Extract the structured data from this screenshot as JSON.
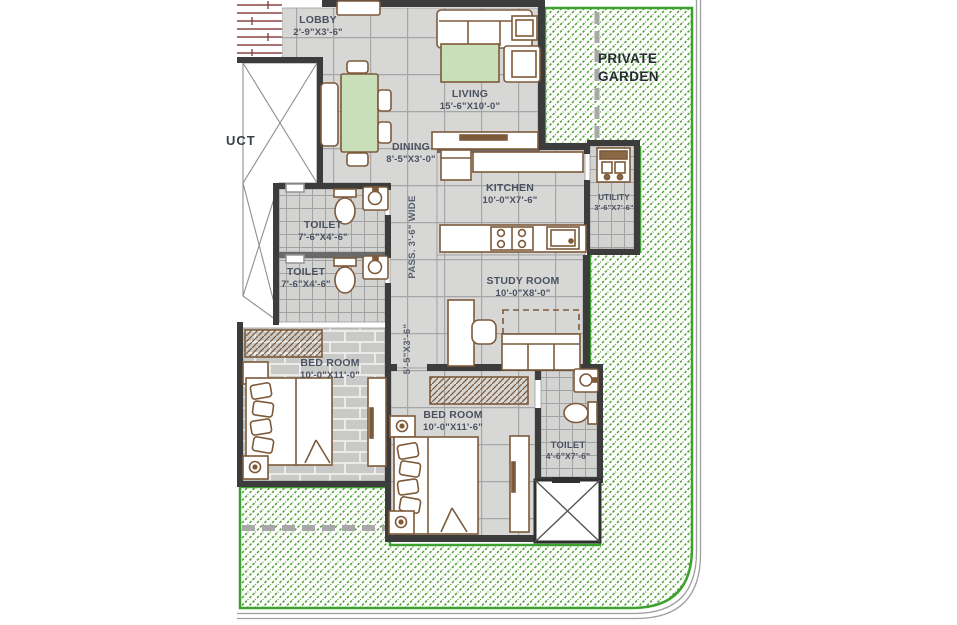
{
  "title": "Apartment floor plan with private garden",
  "garden": {
    "label": "PRIVATE GARDEN"
  },
  "annotations": {
    "duct": "UCT",
    "passage_width": "PASS. 3'-6\" WIDE",
    "passage_dim": "5'-5\"X3'-6\""
  },
  "rooms": {
    "lobby": {
      "name": "LOBBY",
      "size": "2'-9\"X3'-6\""
    },
    "living": {
      "name": "LIVING",
      "size": "15'-6\"X10'-0\""
    },
    "dining": {
      "name": "DINING",
      "size": "8'-5\"X3'-0\""
    },
    "kitchen": {
      "name": "KITCHEN",
      "size": "10'-0\"X7'-6\""
    },
    "utility": {
      "name": "UTILITY",
      "size": "3'-6\"X7'-6\""
    },
    "toilet1": {
      "name": "TOILET",
      "size": "7'-6\"X4'-6\""
    },
    "toilet2": {
      "name": "TOILET",
      "size": "7'-6\"X4'-6\""
    },
    "study": {
      "name": "STUDY ROOM",
      "size": "10'-0\"X8'-0\""
    },
    "bedroom1": {
      "name": "BED ROOM",
      "size": "10'-0\"X11'-0\""
    },
    "bedroom2": {
      "name": "BED ROOM",
      "size": "10'-0\"X11'-6\""
    },
    "toilet3": {
      "name": "TOILET",
      "size": "4'-6\"X7'-6\""
    }
  },
  "colors": {
    "garden_green": "#56a33a",
    "garden_border": "#3da12f",
    "wall_dark": "#3c3c3c",
    "wall_light": "#6a6a6a",
    "floor_gray": "#d7d7d6",
    "furniture_brown": "#7d5a3a",
    "accent_green_fill": "#c9dfba",
    "stair_maroon": "#8a4545",
    "label_text": "#4a5160"
  }
}
